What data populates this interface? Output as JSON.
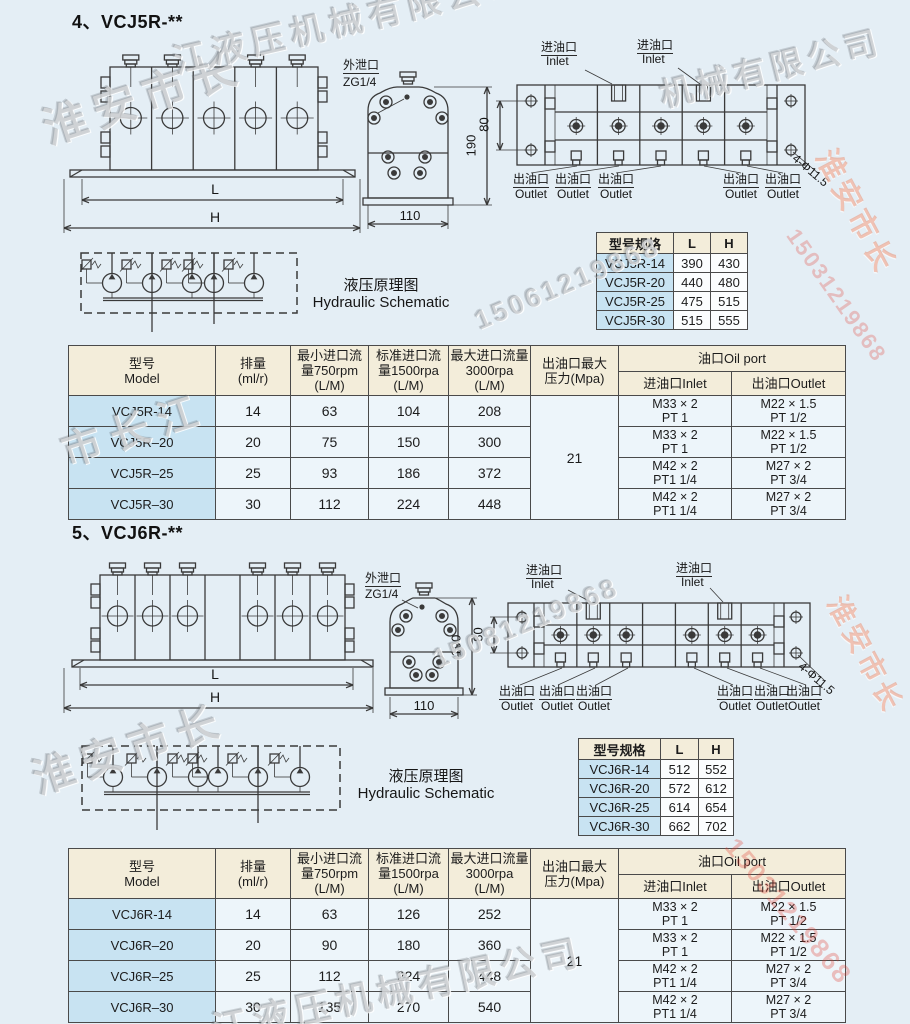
{
  "colors": {
    "background": "#e4eef5",
    "table_border": "#4a4a4a",
    "header_beige": "#f3edda",
    "model_blue": "#c8e3f2",
    "cell_blue": "#edf5fa",
    "line": "#3a3a3a",
    "watermark_red": "#e23e32"
  },
  "dwg": {
    "leak": "外泄口",
    "zg": "ZG1/4",
    "inlet_cn": "进油口",
    "inlet_en": "Inlet",
    "outlet_cn": "出油口",
    "outlet_en": "Outlet",
    "dim_l": "L",
    "dim_h": "H",
    "d110": "110",
    "d190": "190",
    "d80": "80",
    "holes": "4-Φ11.5",
    "sch_cn": "液压原理图",
    "sch_en": "Hydraulic Schematic"
  },
  "watermarks": [
    "淮安市长",
    "江液压机械有限公司",
    "15061219868",
    "机械有限公司",
    "淮安市长",
    "15031219868",
    "市长江",
    "淮安市长",
    "15081219868",
    "淮安市长",
    "江液压机械有限公司",
    "15031219868"
  ],
  "s4": {
    "title": "4、VCJ5R-**",
    "spec": {
      "headers": [
        "型号规格",
        "L",
        "H"
      ],
      "rows": [
        [
          "VCJ5R-14",
          "390",
          "430"
        ],
        [
          "VCJ5R-20",
          "440",
          "480"
        ],
        [
          "VCJ5R-25",
          "475",
          "515"
        ],
        [
          "VCJ5R-30",
          "515",
          "555"
        ]
      ]
    },
    "table": {
      "h_model": [
        "型号",
        "Model"
      ],
      "h_disp": [
        "排量",
        "(ml/r)"
      ],
      "h_min": [
        "最小进口流",
        "量750rpm",
        "(L/M)"
      ],
      "h_std": [
        "标准进口流",
        "量1500rpa",
        "(L/M)"
      ],
      "h_max": [
        "最大进口流量",
        "3000rpa",
        "(L/M)"
      ],
      "h_press": [
        "出油口最大",
        "压力(Mpa)"
      ],
      "h_oil": "油口Oil port",
      "h_in": "进油口Inlet",
      "h_out": "出油口Outlet",
      "pressure": "21",
      "rows": [
        {
          "model": "VCJ5R-14",
          "disp": "14",
          "min": "63",
          "std": "104",
          "max": "208",
          "in1": "M33 × 2",
          "in2": "PT 1",
          "out1": "M22 × 1.5",
          "out2": "PT 1/2"
        },
        {
          "model": "VCJ5R–20",
          "disp": "20",
          "min": "75",
          "std": "150",
          "max": "300",
          "in1": "M33 × 2",
          "in2": "PT 1",
          "out1": "M22 × 1.5",
          "out2": "PT 1/2"
        },
        {
          "model": "VCJ5R–25",
          "disp": "25",
          "min": "93",
          "std": "186",
          "max": "372",
          "in1": "M42 × 2",
          "in2": "PT1 1/4",
          "out1": "M27 × 2",
          "out2": "PT 3/4"
        },
        {
          "model": "VCJ5R–30",
          "disp": "30",
          "min": "112",
          "std": "224",
          "max": "448",
          "in1": "M42 × 2",
          "in2": "PT1 1/4",
          "out1": "M27 × 2",
          "out2": "PT 3/4"
        }
      ]
    }
  },
  "s5": {
    "title": "5、VCJ6R-**",
    "spec": {
      "headers": [
        "型号规格",
        "L",
        "H"
      ],
      "rows": [
        [
          "VCJ6R-14",
          "512",
          "552"
        ],
        [
          "VCJ6R-20",
          "572",
          "612"
        ],
        [
          "VCJ6R-25",
          "614",
          "654"
        ],
        [
          "VCJ6R-30",
          "662",
          "702"
        ]
      ]
    },
    "table": {
      "h_model": [
        "型号",
        "Model"
      ],
      "h_disp": [
        "排量",
        "(ml/r)"
      ],
      "h_min": [
        "最小进口流",
        "量750rpm",
        "(L/M)"
      ],
      "h_std": [
        "标准进口流",
        "量1500rpa",
        "(L/M)"
      ],
      "h_max": [
        "最大进口流量",
        "3000rpa",
        "(L/M)"
      ],
      "h_press": [
        "出油口最大",
        "压力(Mpa)"
      ],
      "h_oil": "油口Oil port",
      "h_in": "进油口Inlet",
      "h_out": "出油口Outlet",
      "pressure": "21",
      "rows": [
        {
          "model": "VCJ6R-14",
          "disp": "14",
          "min": "63",
          "std": "126",
          "max": "252",
          "in1": "M33 × 2",
          "in2": "PT 1",
          "out1": "M22 × 1.5",
          "out2": "PT 1/2"
        },
        {
          "model": "VCJ6R–20",
          "disp": "20",
          "min": "90",
          "std": "180",
          "max": "360",
          "in1": "M33 × 2",
          "in2": "PT 1",
          "out1": "M22 × 1.5",
          "out2": "PT 1/2"
        },
        {
          "model": "VCJ6R–25",
          "disp": "25",
          "min": "112",
          "std": "224",
          "max": "448",
          "in1": "M42 × 2",
          "in2": "PT1 1/4",
          "out1": "M27 × 2",
          "out2": "PT 3/4"
        },
        {
          "model": "VCJ6R–30",
          "disp": "30",
          "min": "135",
          "std": "270",
          "max": "540",
          "in1": "M42 × 2",
          "in2": "PT1 1/4",
          "out1": "M27 × 2",
          "out2": "PT 3/4"
        }
      ]
    }
  }
}
